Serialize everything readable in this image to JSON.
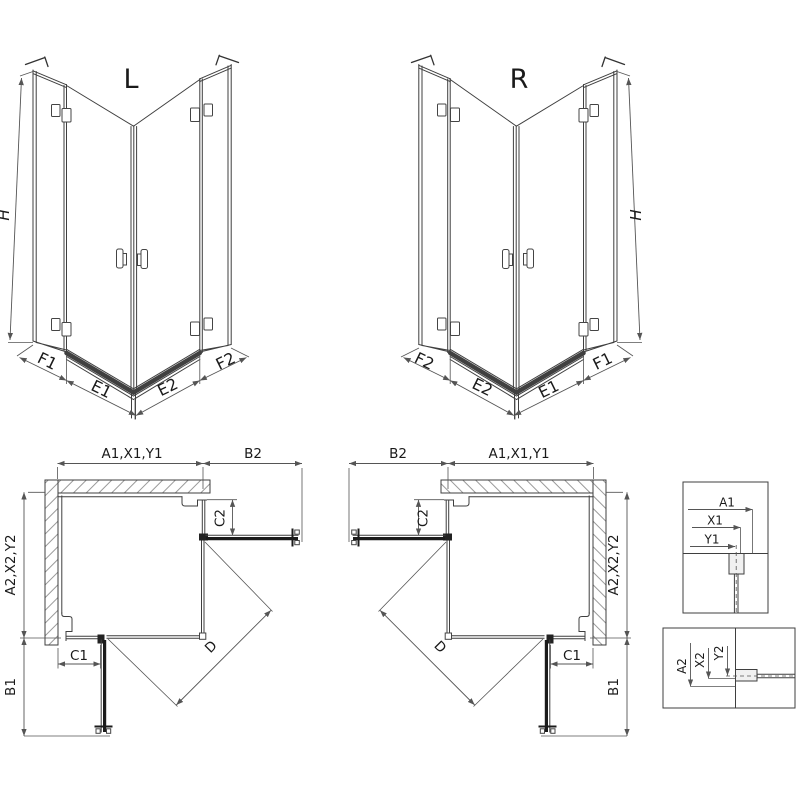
{
  "drawing": {
    "iso_left": {
      "title": "L",
      "height": "H",
      "labels": {
        "outer_left": "F1",
        "door_left": "E1",
        "door_right": "E2",
        "outer_right": "F2"
      }
    },
    "iso_right": {
      "title": "R",
      "height": "H",
      "labels": {
        "outer_left": "F2",
        "door_left": "E2",
        "door_right": "E1",
        "outer_right": "F1"
      }
    },
    "plan_left": {
      "width_top": "A1,X1,Y1",
      "reach_top": "B2",
      "depth_side": "A2,X2,Y2",
      "reach_bottom": "B1",
      "fixed_c1": "C1",
      "fixed_c2": "C2",
      "diagonal": "D"
    },
    "plan_right": {
      "reach_top": "B2",
      "width_top": "A1,X1,Y1",
      "depth_side": "A2,X2,Y2",
      "reach_bottom": "B1",
      "fixed_c1": "C1",
      "fixed_c2": "C2",
      "diagonal": "D"
    },
    "detail_wall": {
      "a": "A1",
      "x": "X1",
      "y": "Y1"
    },
    "detail_floor": {
      "a": "A2",
      "x": "X2",
      "y": "Y2"
    },
    "colors": {
      "line": "#3f3f3f",
      "thick": "#1b1b1b",
      "dim": "#555555",
      "text": "#1a1a1a",
      "hatch": "#8f8f8f"
    }
  }
}
